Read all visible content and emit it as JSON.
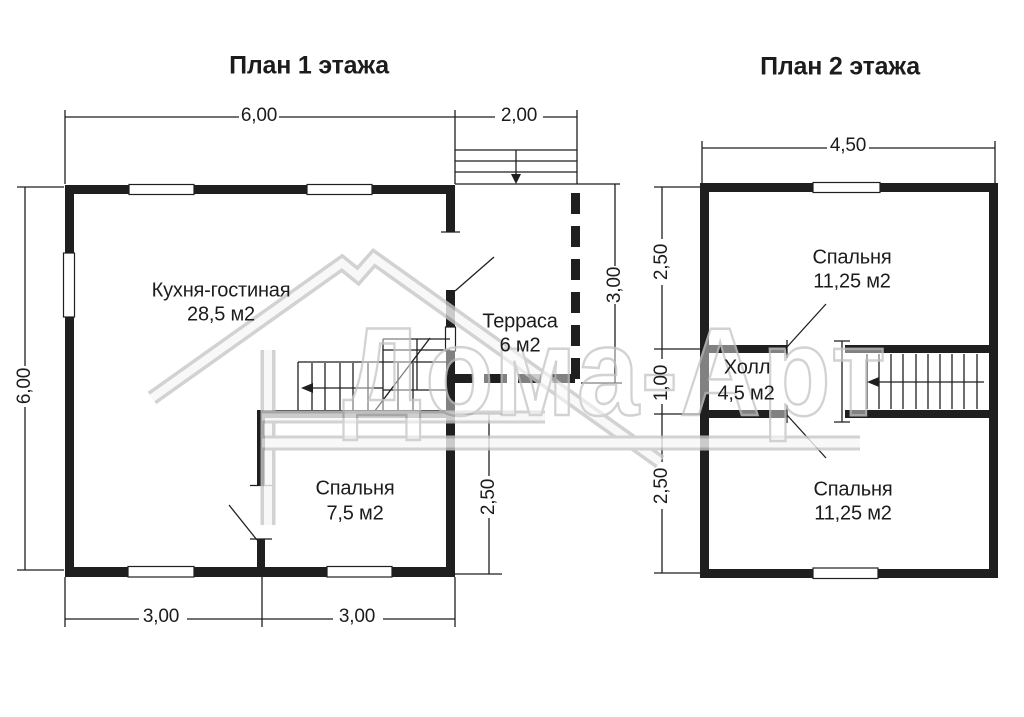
{
  "colors": {
    "ink": "#1f1f1f",
    "watermark_outline": "#c8c8c8"
  },
  "watermark": {
    "text": "Дома-Арт"
  },
  "plan1": {
    "title": "План 1 этажа",
    "rooms": {
      "kitchen": {
        "name": "Кухня-гостиная",
        "area": "28,5 м2"
      },
      "terrace": {
        "name": "Терраса",
        "area": "6 м2"
      },
      "bedroom": {
        "name": "Спальня",
        "area": "7,5 м2"
      }
    },
    "dims": {
      "top_main": "6,00",
      "top_terrace": "2,00",
      "left": "6,00",
      "terrace_right": "3,00",
      "bedroom_right": "2,50",
      "bottom_left": "3,00",
      "bottom_right": "3,00"
    }
  },
  "plan2": {
    "title": "План 2 этажа",
    "rooms": {
      "bedroom_top": {
        "name": "Спальня",
        "area": "11,25 м2"
      },
      "hall": {
        "name": "Холл",
        "area": "4,5 м2"
      },
      "bedroom_bottom": {
        "name": "Спальня",
        "area": "11,25 м2"
      }
    },
    "dims": {
      "top": "4,50",
      "left_top": "2,50",
      "left_middle": "1,00",
      "left_bottom": "2,50"
    }
  }
}
